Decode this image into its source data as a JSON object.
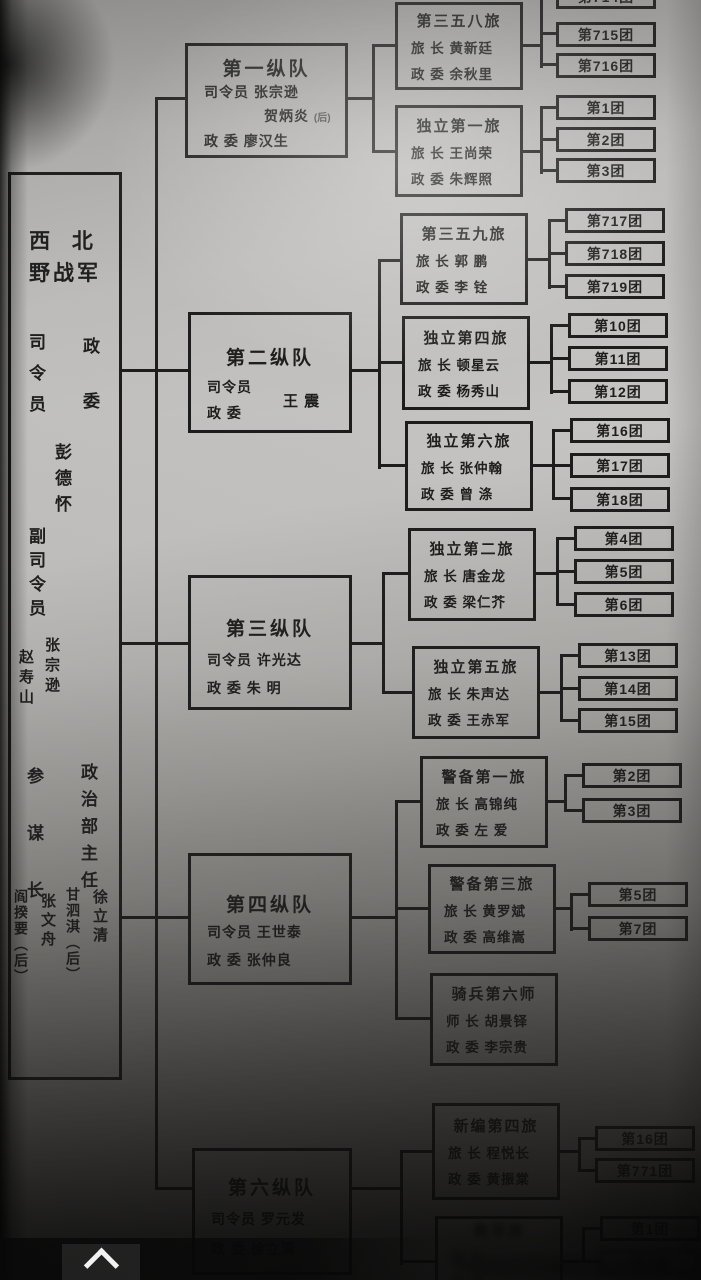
{
  "army": {
    "name_line1": "西 北",
    "name_line2": "野战军",
    "commander_label": "司令员",
    "commissar_label": "政委",
    "commander_commissar_name": "彭德怀",
    "deputy_commander_label": "副司令员",
    "deputy_commanders": [
      "张宗逊",
      "赵寿山"
    ],
    "chief_of_staff_label": "参谋长",
    "chiefs_of_staff": [
      "张文舟",
      "阎揆要（后）"
    ],
    "political_director_label": "政治部主任",
    "political_directors": [
      "徐立清",
      "甘泗淇（后）"
    ]
  },
  "columns": [
    {
      "title": "第一纵队",
      "line1": "司令员  张宗逊",
      "line2_name": "贺炳炎",
      "line2_suffix": "(后)",
      "line3": "政  委  廖汉生",
      "brigades": [
        {
          "title": "第三五八旅",
          "line1": "旅  长  黄新廷",
          "line2": "政  委  余秋里",
          "regiments": [
            "第714团",
            "第715团",
            "第716团"
          ]
        },
        {
          "title": "独立第一旅",
          "line1": "旅  长  王尚荣",
          "line2": "政  委  朱辉照",
          "regiments": [
            "第1团",
            "第2团",
            "第3团"
          ]
        }
      ]
    },
    {
      "title": "第二纵队",
      "commander_label": "司令员",
      "commissar_label": "政  委",
      "leader_name": "王  震",
      "brigades": [
        {
          "title": "第三五九旅",
          "line1": "旅  长  郭  鹏",
          "line2": "政  委  李  铨",
          "regiments": [
            "第717团",
            "第718团",
            "第719团"
          ]
        },
        {
          "title": "独立第四旅",
          "line1": "旅  长  顿星云",
          "line2": "政  委  杨秀山",
          "regiments": [
            "第10团",
            "第11团",
            "第12团"
          ]
        },
        {
          "title": "独立第六旅",
          "line1": "旅  长  张仲翰",
          "line2": "政  委  曾  涤",
          "regiments": [
            "第16团",
            "第17团",
            "第18团"
          ]
        }
      ]
    },
    {
      "title": "第三纵队",
      "line1": "司令员  许光达",
      "line2": "政  委  朱  明",
      "brigades": [
        {
          "title": "独立第二旅",
          "line1": "旅  长  唐金龙",
          "line2": "政  委  梁仁芥",
          "regiments": [
            "第4团",
            "第5团",
            "第6团"
          ]
        },
        {
          "title": "独立第五旅",
          "line1": "旅  长  朱声达",
          "line2": "政  委  王赤军",
          "regiments": [
            "第13团",
            "第14团",
            "第15团"
          ]
        }
      ]
    },
    {
      "title": "第四纵队",
      "line1": "司令员  王世泰",
      "line2": "政  委  张仲良",
      "brigades": [
        {
          "title": "警备第一旅",
          "line1": "旅  长  高锦纯",
          "line2": "政  委  左  爱",
          "regiments": [
            "第2团",
            "第3团"
          ]
        },
        {
          "title": "警备第三旅",
          "line1": "旅  长  黄罗斌",
          "line2": "政  委  高维嵩",
          "regiments": [
            "第5团",
            "第7团"
          ]
        },
        {
          "title": "骑兵第六师",
          "line1": "师  长  胡景铎",
          "line2": "政  委  李宗贵",
          "regiments": []
        }
      ]
    },
    {
      "title": "第六纵队",
      "line1": "司令员  罗元发",
      "line2": "政  委  徐立清",
      "brigades": [
        {
          "title": "新编第四旅",
          "line1": "旅  长  程悦长",
          "line2": "政  委  黄振棠",
          "regiments": [
            "第16团",
            "第771团"
          ]
        },
        {
          "title": "教导旅",
          "line1": "旅  长",
          "line2": "政  委",
          "note": "blurred",
          "regiments": [
            "第1团",
            "第2团"
          ]
        }
      ]
    }
  ],
  "ui": {
    "collapse_icon": "chevron-up"
  }
}
